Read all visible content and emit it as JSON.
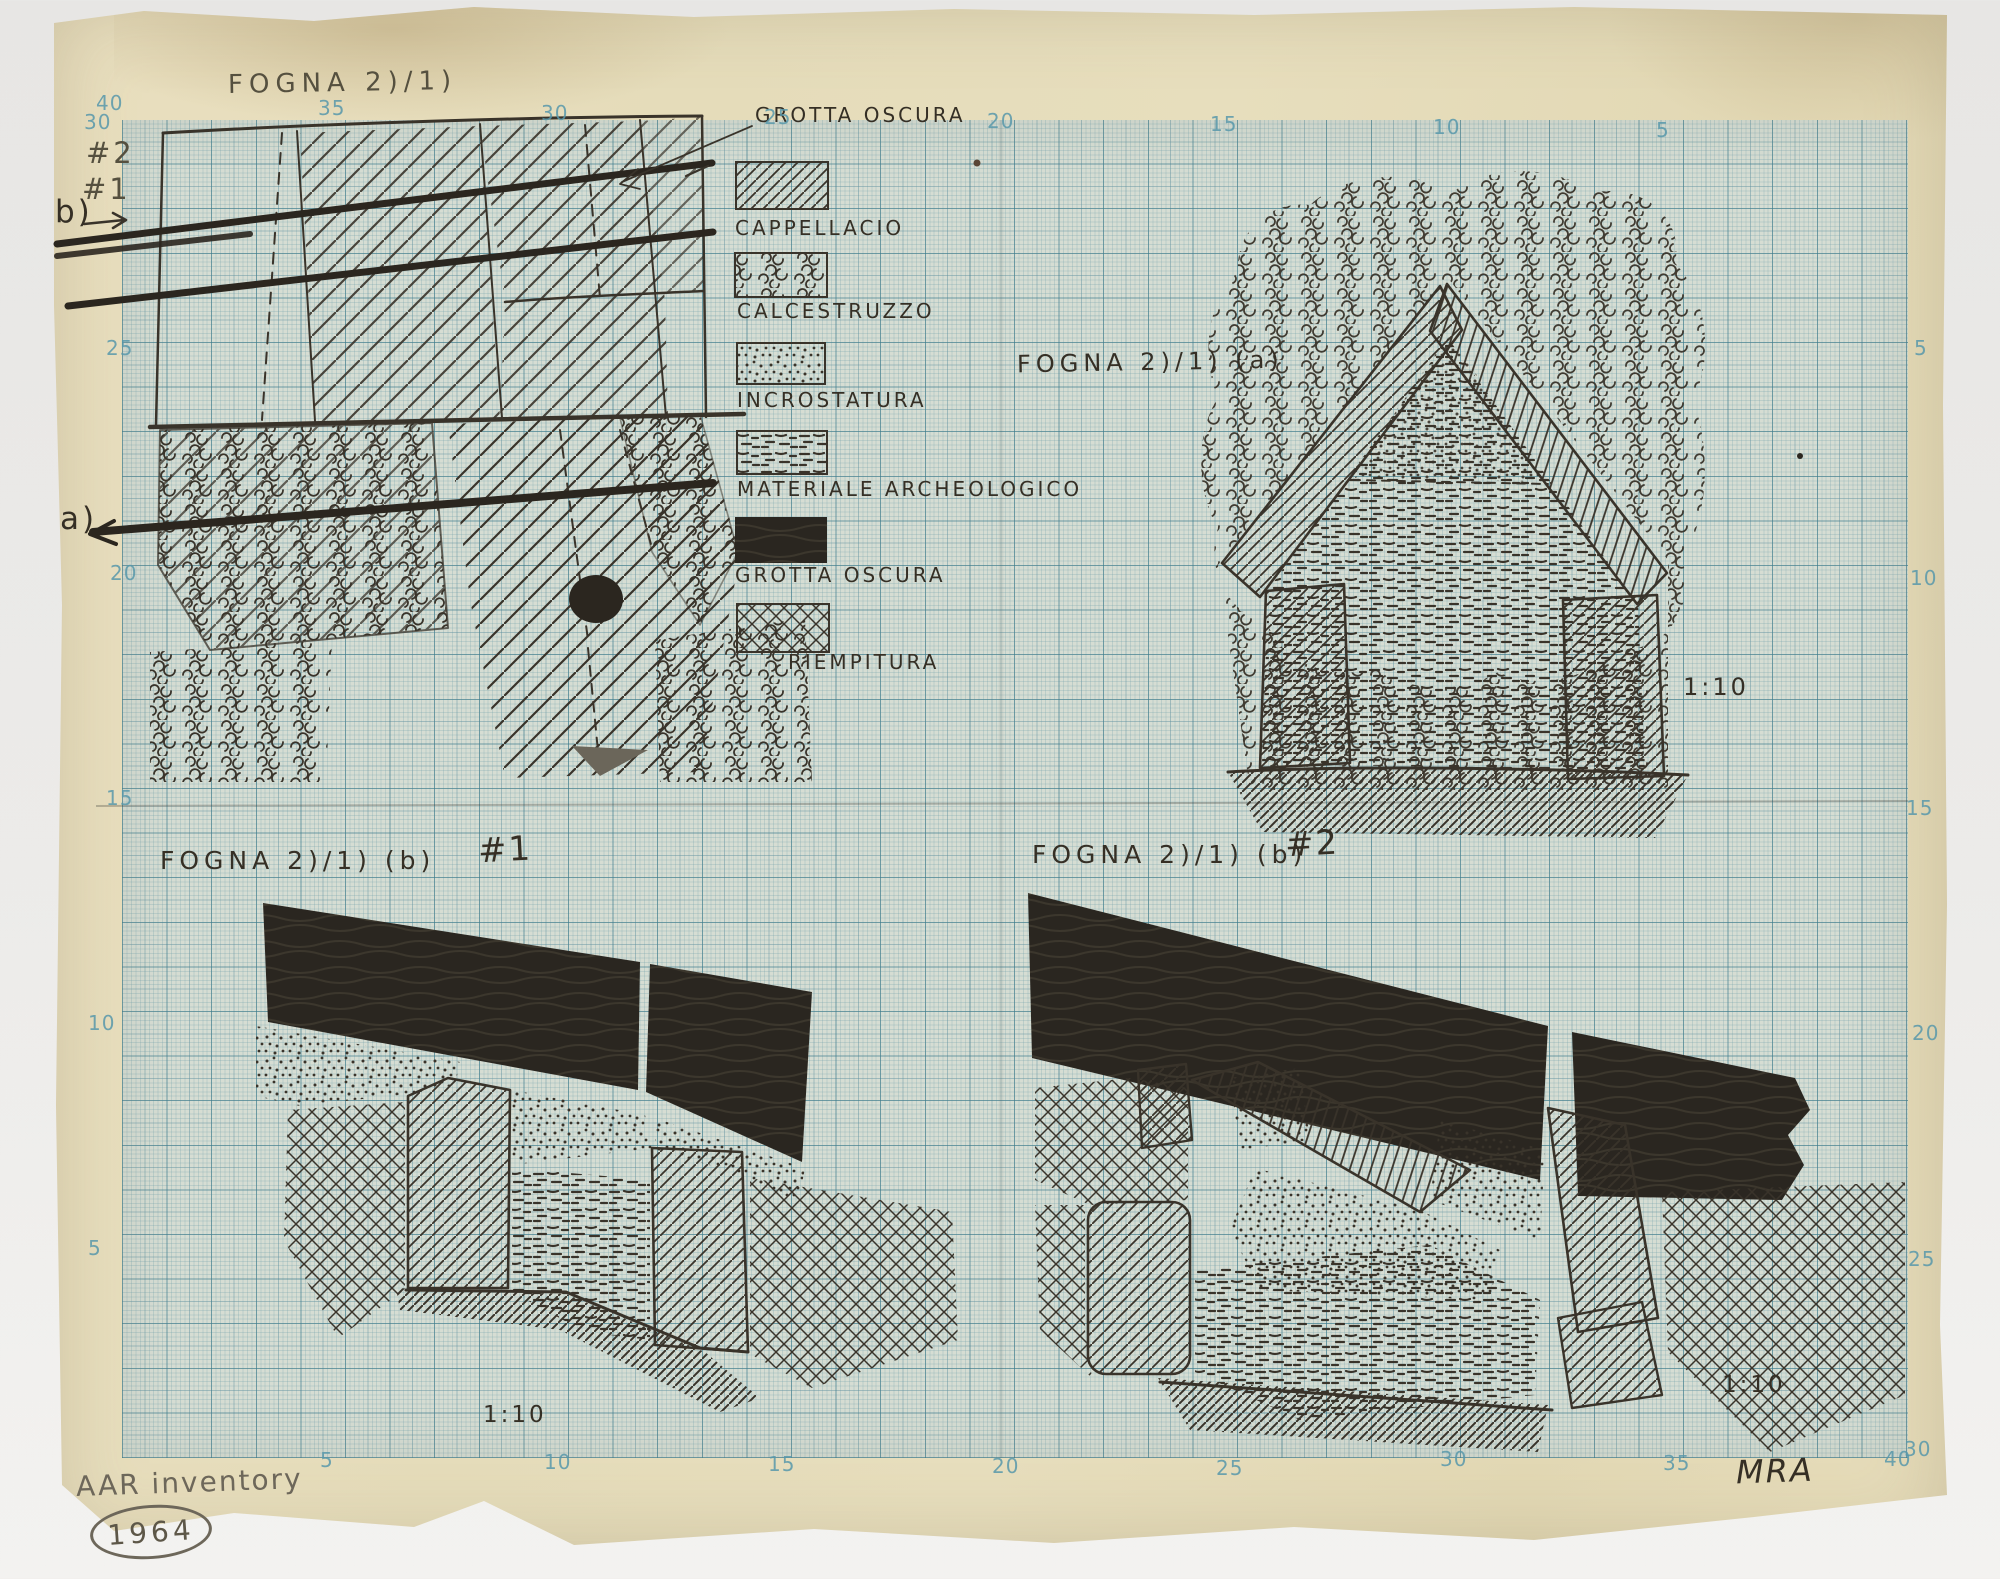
{
  "palette": {
    "scan_background": "#ecebe9",
    "paper_cream": "#e5dcba",
    "grid_paper": "#d6ddd3",
    "grid_line_blue": "#6ea0aa",
    "ink": "#352f25",
    "pencil": "#55503f",
    "edge_number_blue": "#5898ab"
  },
  "titles": {
    "plan": "FOGNA 2)/1)",
    "panel_a": "FOGNA 2)/1) (a)",
    "panel_b1": "FOGNA 2)/1) (b)",
    "panel_b1_num": "#1",
    "panel_b2": "FOGNA 2)/1) (b)",
    "panel_b2_num": "#2",
    "scale_a": "1:10",
    "scale_b1": "1:10",
    "scale_b2": "1:10"
  },
  "plan_annotations": {
    "line2": "#2",
    "line1": "#1",
    "section_b": "b)",
    "section_a": "a)",
    "callout": "GROTTA OSCURA"
  },
  "legend": {
    "items": [
      {
        "pattern": "diagonal-hatch",
        "label": "CAPPELLACIO"
      },
      {
        "pattern": "pebble-scribble",
        "label": "CALCESTRUZZO"
      },
      {
        "pattern": "stipple-dots",
        "label": "INCROSTATURA"
      },
      {
        "pattern": "short-dashes",
        "label": "MATERIALE ARCHEOLOGICO"
      },
      {
        "pattern": "solid-dark",
        "label": "GROTTA OSCURA"
      },
      {
        "pattern": "crosshatch",
        "label": "RIEMPITURA"
      }
    ]
  },
  "footer": {
    "inventory": "AAR inventory",
    "year": "1964",
    "initials": "MRA"
  },
  "grid_numbers": {
    "top": [
      "40",
      "35",
      "30",
      "25",
      "20",
      "15",
      "10",
      "5"
    ],
    "left": [
      "30",
      "25",
      "20",
      "15",
      "10",
      "5"
    ],
    "right": [
      "5",
      "10",
      "15",
      "20",
      "25",
      "30"
    ],
    "bottom": [
      "5",
      "10",
      "15",
      "20",
      "25",
      "30",
      "35",
      "40"
    ]
  }
}
